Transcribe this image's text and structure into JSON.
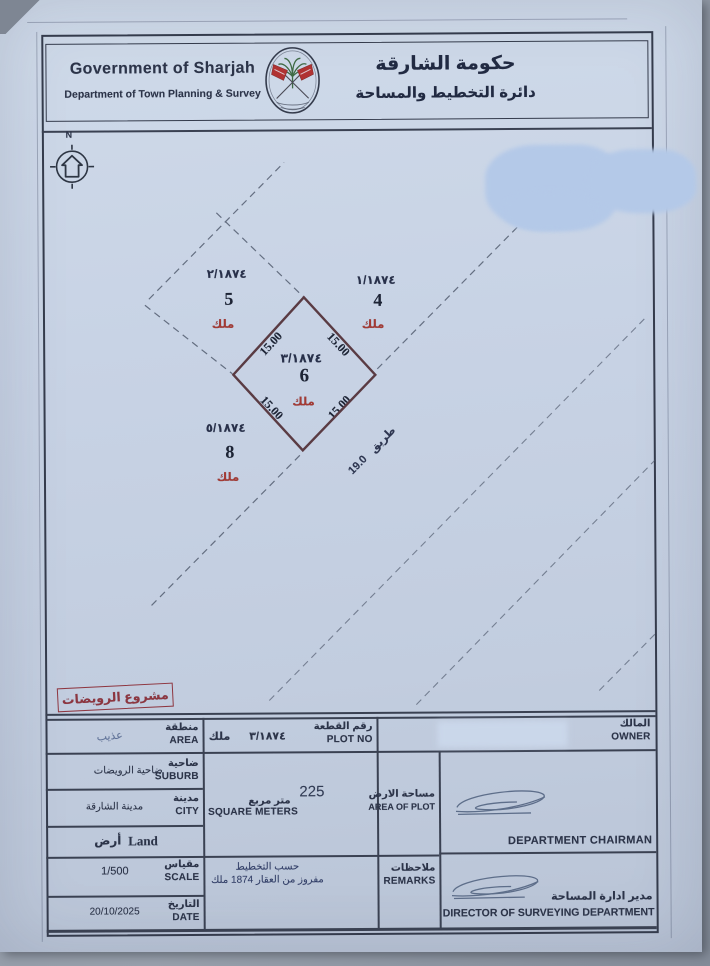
{
  "header": {
    "title_en": "Government of Sharjah",
    "subtitle_en": "Department of Town Planning & Survey",
    "title_ar": "حكومة الشارقة",
    "subtitle_ar": "دائرة التخطيط والمساحة"
  },
  "compass": {
    "north_label": "N"
  },
  "plan": {
    "plot": {
      "parcel_no": "٣/١٨٧٤",
      "number": "6",
      "tenure_ar": "ملك",
      "sides": {
        "top_left": "15.00",
        "top_right": "15.00",
        "bottom_left": "15.00",
        "bottom_right": "15.00"
      }
    },
    "neighbor_left": {
      "parcel_no": "٢/١٨٧٤",
      "number": "5",
      "tenure_ar": "ملك"
    },
    "neighbor_right": {
      "parcel_no": "١/١٨٧٤",
      "number": "4",
      "tenure_ar": "ملك"
    },
    "neighbor_bottom": {
      "parcel_no": "٥/١٨٧٤",
      "number": "8",
      "tenure_ar": "ملك"
    },
    "road": {
      "name_ar": "طريق",
      "width": "19.0"
    },
    "stamp_ar": "مشروع الرويضات"
  },
  "table": {
    "area": {
      "label_ar": "منطقة",
      "label_en": "AREA",
      "value_ar": "عذيب"
    },
    "plot_no": {
      "label_ar": "رقم القطعة",
      "label_en": "PLOT NO",
      "value": "٣/١٨٧٤",
      "tenure_ar": "ملك"
    },
    "owner": {
      "label_ar": "المالك",
      "label_en": "OWNER"
    },
    "suburb": {
      "label_ar": "ضاحية",
      "label_en": "SUBURB",
      "value_ar": "ضاحية الرويضات"
    },
    "city": {
      "label_ar": "مدينة",
      "label_en": "CITY",
      "value_ar": "مدينة الشارقة"
    },
    "land": {
      "value_ar": "أرض",
      "value_en": "Land"
    },
    "area_of_plot": {
      "label_ar": "مساحة الارض",
      "label_en": "AREA OF PLOT",
      "value": "225",
      "unit_ar": "متر مربع",
      "unit_en": "SQUARE METERS"
    },
    "scale": {
      "label_ar": "مقياس",
      "label_en": "SCALE",
      "value": "1/500"
    },
    "date": {
      "label_ar": "التاريخ",
      "label_en": "DATE",
      "value": "20/10/2025"
    },
    "remarks": {
      "label_ar": "ملاحظات",
      "label_en": "REMARKS",
      "line1_ar": "حسب التخطيط",
      "line2_ar": "مفروز من العقار 1874 ملك"
    },
    "signatures": {
      "chairman_en": "DEPARTMENT CHAIRMAN",
      "director_ar": "مدير ادارة المساحة",
      "director_en": "DIRECTOR OF SURVEYING DEPARTMENT"
    }
  },
  "colors": {
    "ink": "#2c3449",
    "accent_red": "#a43a34",
    "stamp_red": "#8e3640",
    "plot_line": "#5a3b43",
    "paper": "#c6d1e2"
  }
}
